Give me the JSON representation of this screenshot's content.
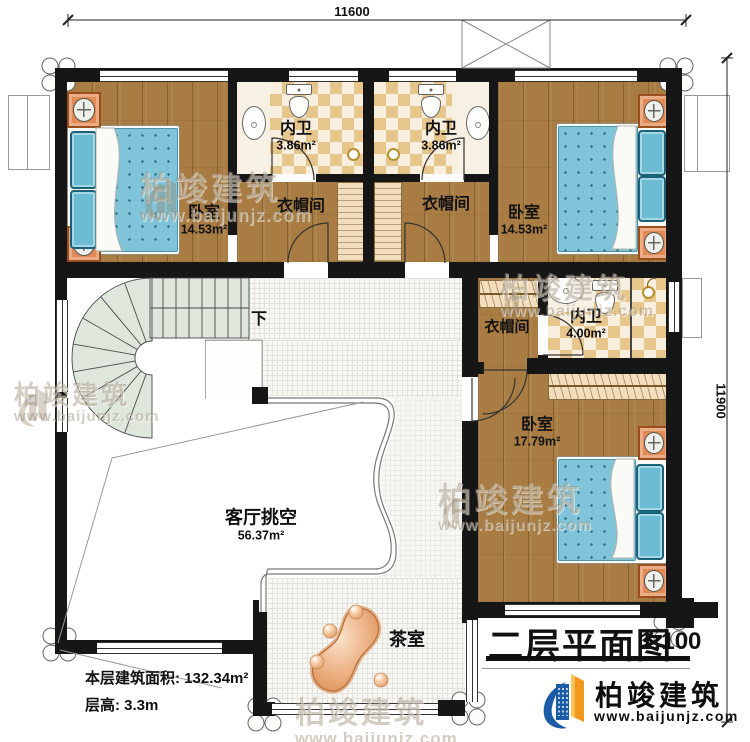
{
  "dimensions": {
    "top": "11600",
    "right": "11900"
  },
  "rooms": {
    "bedroom_tl": {
      "name": "卧室",
      "area": "14.53m²"
    },
    "bath_tl": {
      "name": "内卫",
      "area": "3.86m²"
    },
    "cloak_tl": {
      "name": "衣帽间"
    },
    "bath_tr": {
      "name": "内卫",
      "area": "3.86m²"
    },
    "cloak_tr": {
      "name": "衣帽间"
    },
    "bedroom_tr": {
      "name": "卧室",
      "area": "14.53m²"
    },
    "cloak_mid": {
      "name": "衣帽间"
    },
    "bath_mid": {
      "name": "内卫",
      "area": "4.00m²"
    },
    "bedroom_br": {
      "name": "卧室",
      "area": "17.79m²"
    },
    "living_void": {
      "name": "客厅挑空",
      "area": "56.37m²"
    },
    "tea_room": {
      "name": "茶室"
    },
    "stair": {
      "down_label": "下"
    }
  },
  "info": {
    "area_label": "本层建筑面积:",
    "area_value": "132.34m²",
    "height_label": "层高:",
    "height_value": "3.3m"
  },
  "title": {
    "text": "二层平面图",
    "scale": "1:100"
  },
  "brand": {
    "name": "柏竣建筑",
    "url": "www.baijunjz.com"
  },
  "colors": {
    "wall": "#161616",
    "wood": "#a87c42",
    "checker": "#e7c68c",
    "bed_blue": "#7fc4d8",
    "stair_green": "#dfe7dd",
    "logo_blue": "#1b5ca8",
    "logo_orange": "#f2981d"
  }
}
